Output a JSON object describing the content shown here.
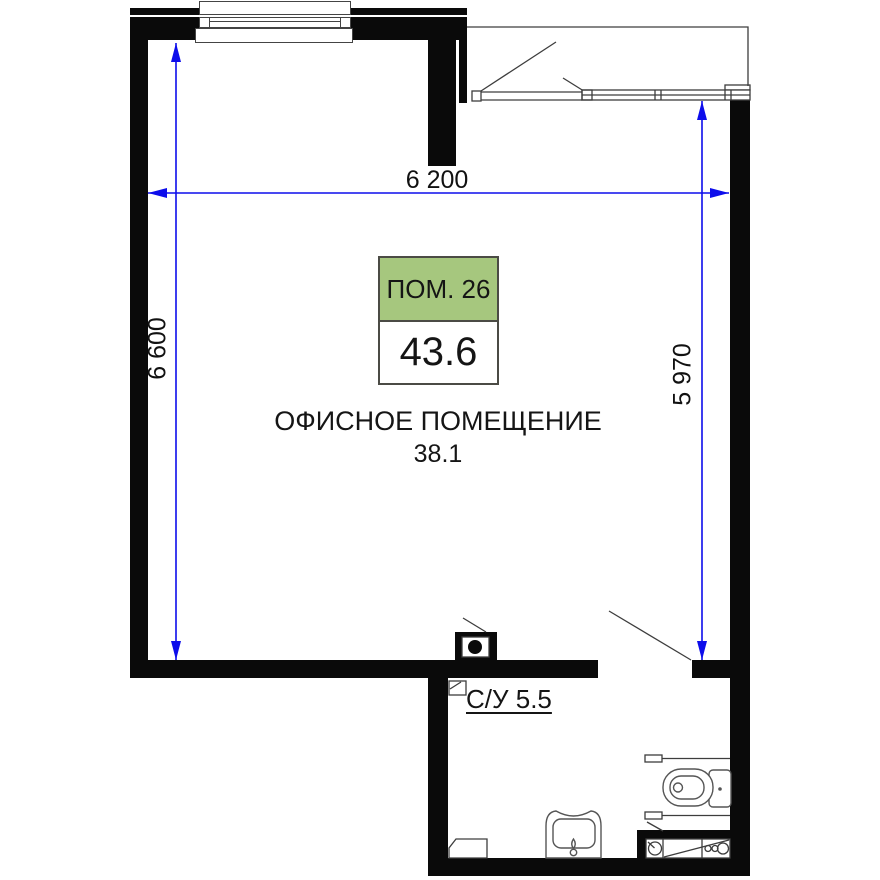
{
  "plan": {
    "unit_label": {
      "room_no": "ПОМ. 26",
      "area": "43.6"
    },
    "office": {
      "name": "ОФИСНОЕ ПОМЕЩЕНИЕ",
      "area": "38.1"
    },
    "bathroom_label": "С/У 5.5",
    "dimensions": {
      "width_top": "6 200",
      "height_left": "6 600",
      "height_right": "5 970"
    },
    "colors": {
      "label_green": "#a6c77e",
      "dimension_blue": "#0d0deb",
      "wall_black": "#0a0a0a"
    }
  }
}
